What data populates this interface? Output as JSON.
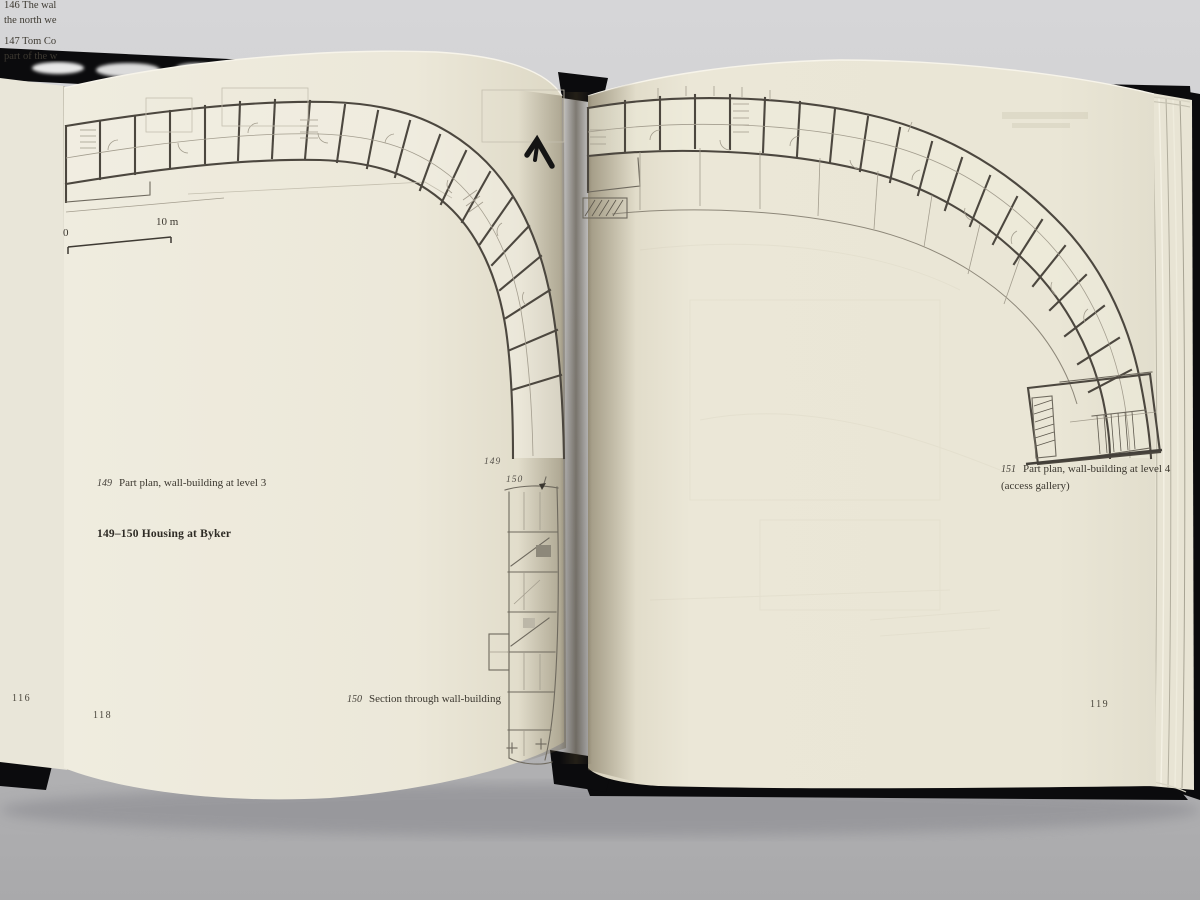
{
  "book": {
    "left_edge_page": {
      "page_number": "116",
      "cap146_l1": "146  The wal",
      "cap146_l2": "the north we",
      "cap147_l1": "147  Tom Co",
      "cap147_l2": "part of the w"
    },
    "left_page": {
      "page_number": "118",
      "scale": {
        "zero": "0",
        "ten": "10 m"
      },
      "fig_label_149": "149",
      "fig_label_150": "150",
      "cap149": {
        "num": "149",
        "text": "Part plan, wall-building at level 3"
      },
      "heading": "149–150 Housing at Byker",
      "cap150": {
        "num": "150",
        "text": "Section through wall-building"
      }
    },
    "right_page": {
      "page_number": "119",
      "cap151": {
        "num": "151",
        "text": "Part plan, wall-building at level 4",
        "text2": "(access gallery)"
      }
    }
  }
}
